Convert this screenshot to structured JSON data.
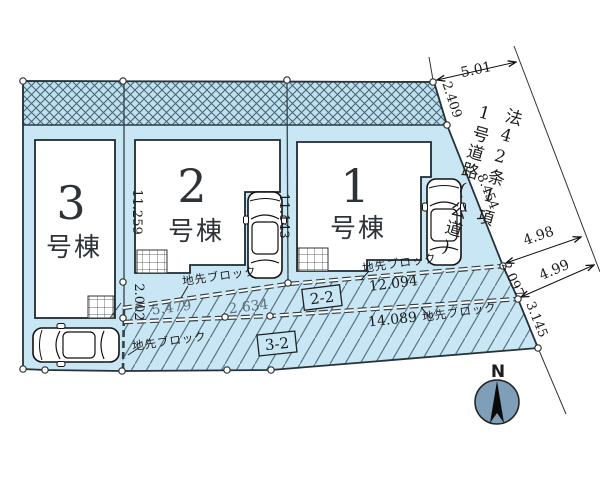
{
  "plan": {
    "lots": [
      {
        "num": "3",
        "suffix": "号棟"
      },
      {
        "num": "2",
        "suffix": "号棟"
      },
      {
        "num": "1",
        "suffix": "号棟"
      }
    ],
    "road": {
      "line1": "法42条1項",
      "line2": "1号道路(公道)"
    },
    "labels": {
      "curb": "地先ブロック",
      "section_a": "2-2",
      "section_b": "3-2",
      "north": "N"
    },
    "dims": {
      "top": "5.01",
      "band_side": "2.409",
      "road_edge": "8.454",
      "road_w1": "4.98",
      "road_w2": "4.99",
      "edge_mid": "2.097",
      "edge_low": "3.145",
      "b32_upper": "11.259",
      "b32_lower": "2.002",
      "b21": "11.143",
      "a1": "5.479",
      "a2": "2.634",
      "a_main": "12.094",
      "b_main": "14.089"
    },
    "colors": {
      "parcel": "#c8e6f4",
      "band_bg": "#bfe0ef",
      "building": "#ffffff",
      "compass": "#7f9eb8",
      "ink": "#1c1c1c"
    }
  }
}
